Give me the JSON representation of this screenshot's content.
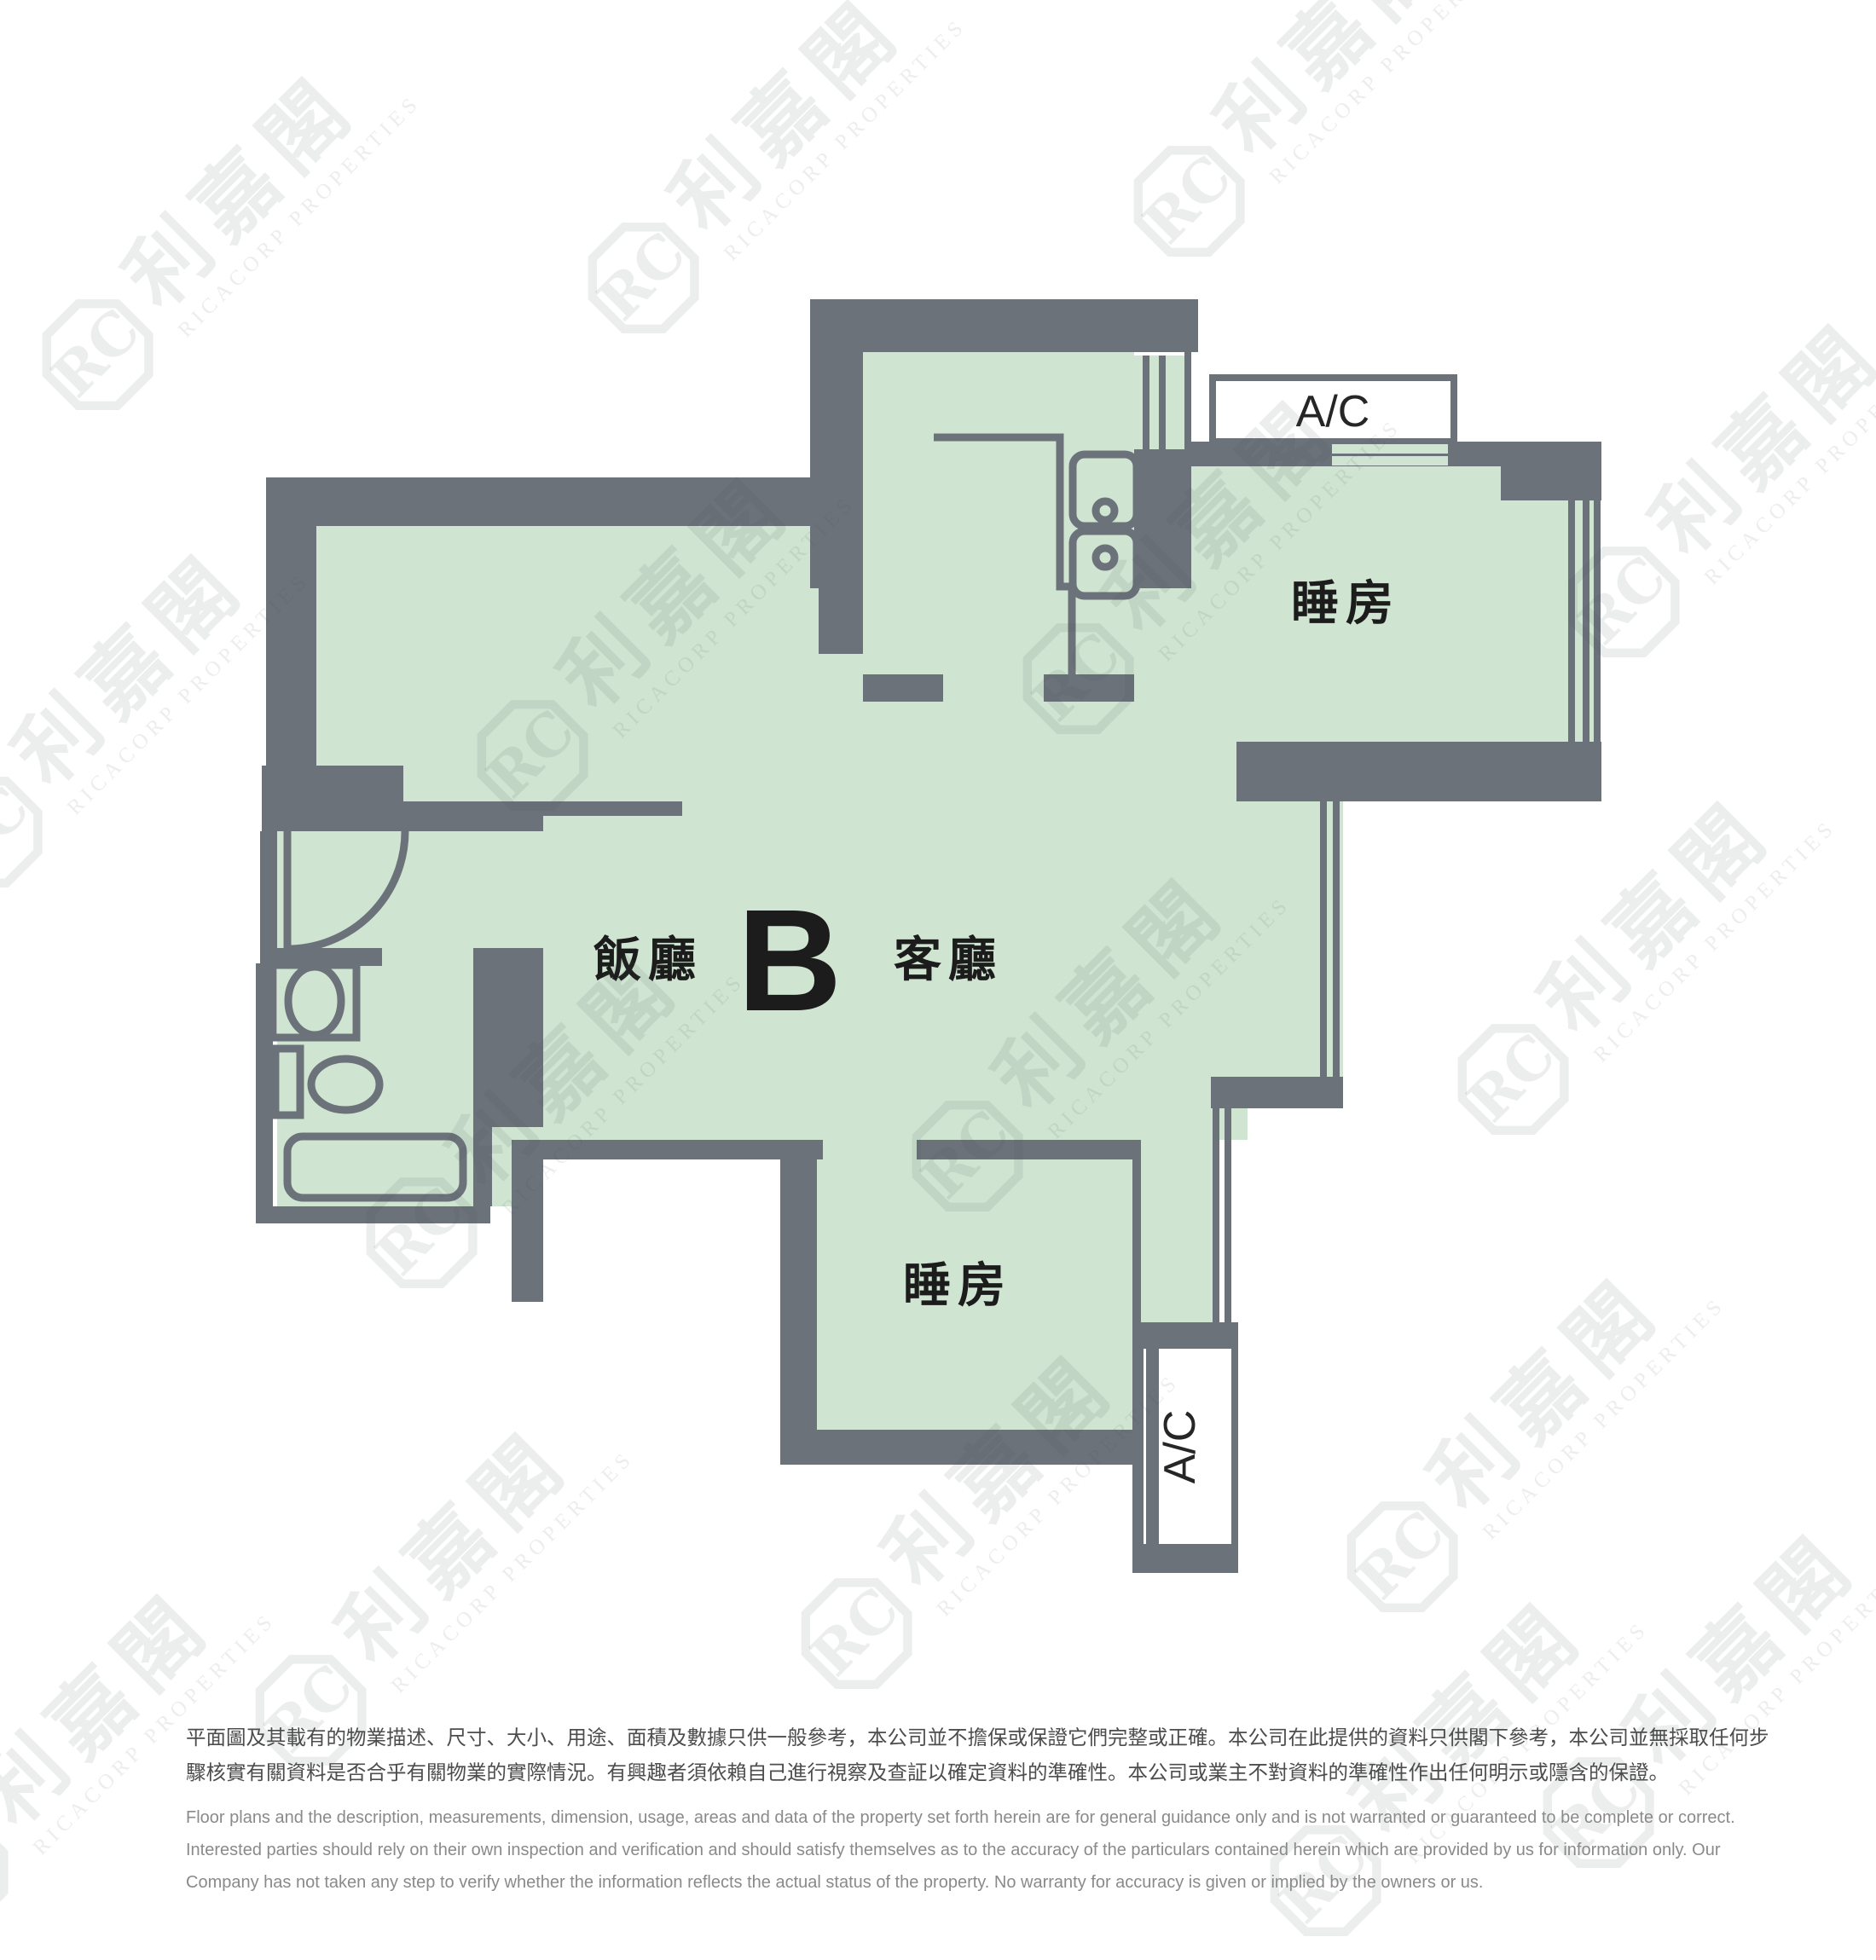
{
  "floorplan": {
    "unit_label": "B",
    "dining_label": "飯廳",
    "living_label": "客廳",
    "bedroom_top_label": "睡房",
    "bedroom_bottom_label": "睡房",
    "ac_top_label": "A/C",
    "ac_bottom_label": "A/C",
    "colors": {
      "wall": "#6C727A",
      "floor": "#CFE5D1"
    }
  },
  "watermark": {
    "logo_initials": "RC",
    "name_zh": "利嘉閣",
    "name_en": "RICACORP PROPERTIES"
  },
  "disclaimer": {
    "zh": [
      "平面圖及其載有的物業描述、尺寸、大小、用途、面積及數據只供一般參考，本公司並不擔保或保證它們完整或正確。本公司在此提供的資料只供閣下參考，本公司並無採取任何步",
      "驟核實有關資料是否合乎有關物業的實際情況。有興趣者須依賴自己進行視察及查証以確定資料的準確性。本公司或業主不對資料的準確性作出任何明示或隱含的保證。"
    ],
    "en": [
      "Floor plans and the description, measurements, dimension, usage, areas and data of the property set forth herein are for general guidance only and is not warranted or guaranteed to be complete or correct.",
      "Interested parties should rely on their own inspection and verification and should satisfy themselves as to the accuracy of the particulars contained herein which are provided by us for information only.  Our",
      "Company has not taken any step to verify whether the information reflects the actual status of the property.  No warranty for accuracy is given or implied by the owners or us."
    ]
  }
}
